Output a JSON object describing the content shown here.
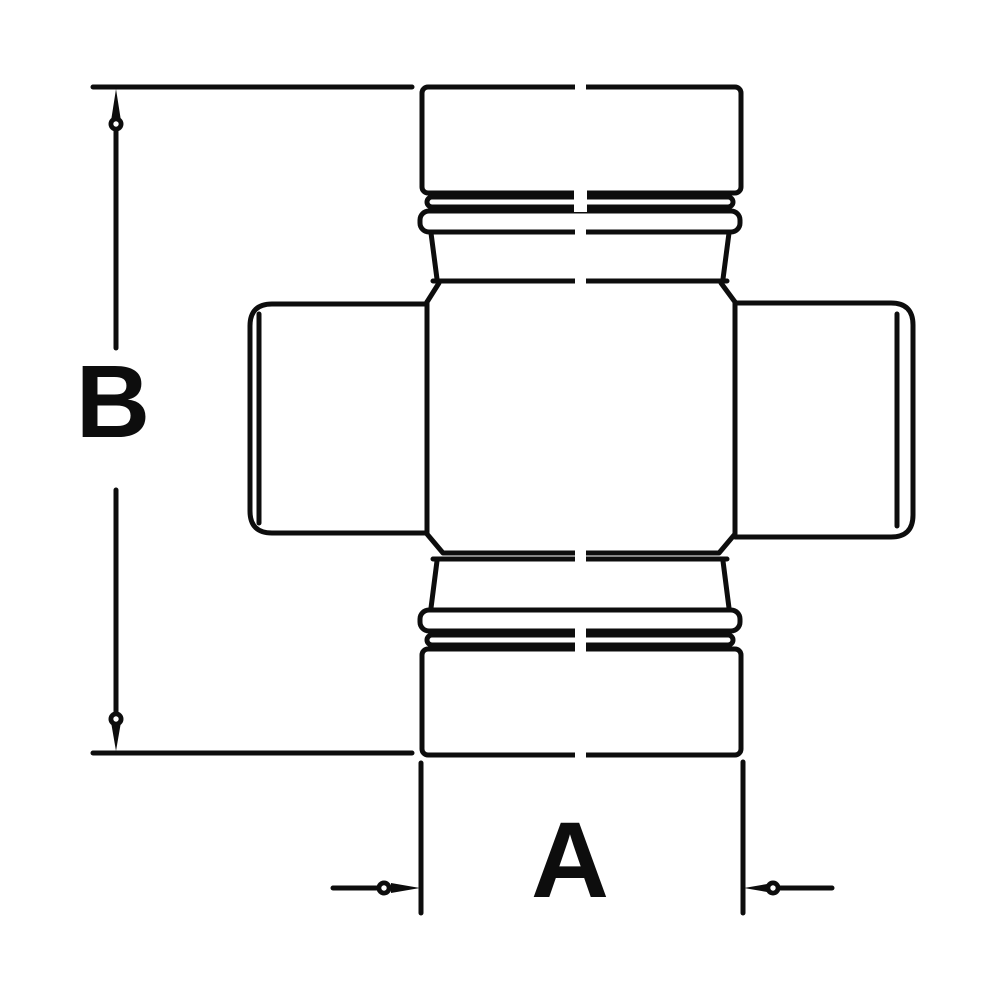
{
  "figure": {
    "type": "technical-line-drawing",
    "subject": "Universal joint cross with four bearing cups",
    "background_color": "#ffffff",
    "line_color": "#0d0d0d",
    "dimension_b": {
      "label": "B",
      "orientation": "vertical",
      "measures": "overall length from top cap to bottom cap"
    },
    "dimension_a": {
      "label": "A",
      "orientation": "horizontal",
      "measures": "bearing cap width across bottom cup"
    }
  }
}
